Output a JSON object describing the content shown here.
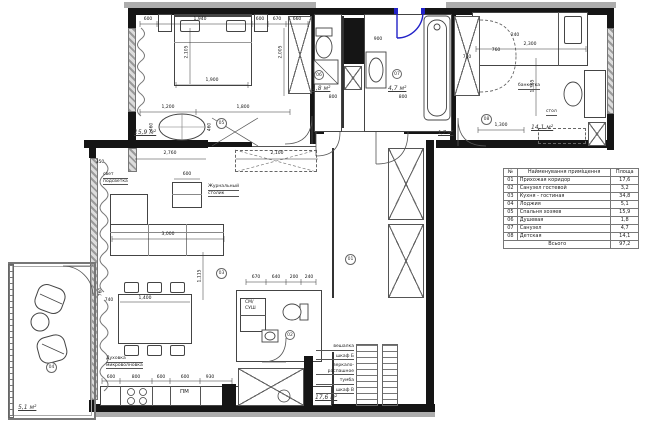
{
  "legend": {
    "headers": [
      "№",
      "Найменування приміщення",
      "Площа"
    ],
    "rows": [
      {
        "num": "01",
        "name": "Прихожая коридор",
        "area": "17,6"
      },
      {
        "num": "02",
        "name": "Санузел гостевой",
        "area": "3,2"
      },
      {
        "num": "03",
        "name": "Кухня - гостиная",
        "area": "34,8"
      },
      {
        "num": "04",
        "name": "Лоджия",
        "area": "5,1"
      },
      {
        "num": "05",
        "name": "Спальня хозяев",
        "area": "15,9"
      },
      {
        "num": "06",
        "name": "Душевая",
        "area": "1,8"
      },
      {
        "num": "07",
        "name": "Санузел",
        "area": "4,7"
      },
      {
        "num": "08",
        "name": "Детская",
        "area": "14,1"
      }
    ],
    "total_label": "Всього",
    "total_value": "97,2"
  },
  "rooms": {
    "hallway": {
      "number": "01",
      "area": "17,6 м²"
    },
    "wc_guest": {
      "number": "02"
    },
    "kitchen_living": {
      "number": "03"
    },
    "loggia": {
      "number": "04",
      "area": "5,1 м²"
    },
    "bedroom": {
      "number": "05",
      "area": "15,9 м²"
    },
    "shower": {
      "number": "06",
      "area": "1,8 м²"
    },
    "bathroom": {
      "number": "07",
      "area": "4,7 м²"
    },
    "kids": {
      "number": "08",
      "area": "14,1 м²"
    },
    "closet": {
      "area": "1,7 м²"
    }
  },
  "labels": {
    "light_1": "свет",
    "light_2": "подсветка",
    "coffee_1": "Журнальный",
    "coffee_2": "столик",
    "oven_1": "Духовка",
    "oven_2": "микроволновка",
    "pm": "ПМ",
    "wash_1": "СМ/",
    "wash_2": "СУШ",
    "hall_1": "вешалка",
    "hall_2": "шкаф Б",
    "hall_3": "зеркало-",
    "hall_4": "распашное",
    "hall_5": "тумба",
    "hall_6": "шкаф В",
    "desk": "стол",
    "bench": "банкетка"
  },
  "dims": {
    "bd_top_1": "600",
    "bd_top_2": "1,940",
    "bd_top_3": "600",
    "bd_top_4": "670",
    "bd_top_5": "660",
    "bd_bed_w": "1,900",
    "bd_bed_h": "2,105",
    "bd_ward": "2,005",
    "bd_mid_1": "1,200",
    "bd_mid_2": "1,800",
    "bd_ott_1": "460",
    "bd_ott_2": "460",
    "lv_top_1": "2,760",
    "lv_top_2": "2,100",
    "lv_coffee": "600",
    "lv_sofa": "3,000",
    "lv_vert": "1,115",
    "lv_left_1": "350",
    "lv_left_2": "760",
    "dt_w": "1,400",
    "dt_l": "740",
    "kt_1": "600",
    "kt_2": "800",
    "kt_3": "600",
    "kt_4": "600",
    "kt_5": "930",
    "cor_1": "670",
    "cor_2": "640",
    "cor_3": "200",
    "cor_4": "240",
    "bath_1": "900",
    "bath_2": "400",
    "bath_3": "800",
    "bath_4": "800",
    "kid_bed": "2,300",
    "kid_1": "1,300",
    "kid_2": "1,365",
    "kid_3": "740",
    "kid_4": "760",
    "kid_5": "240"
  }
}
